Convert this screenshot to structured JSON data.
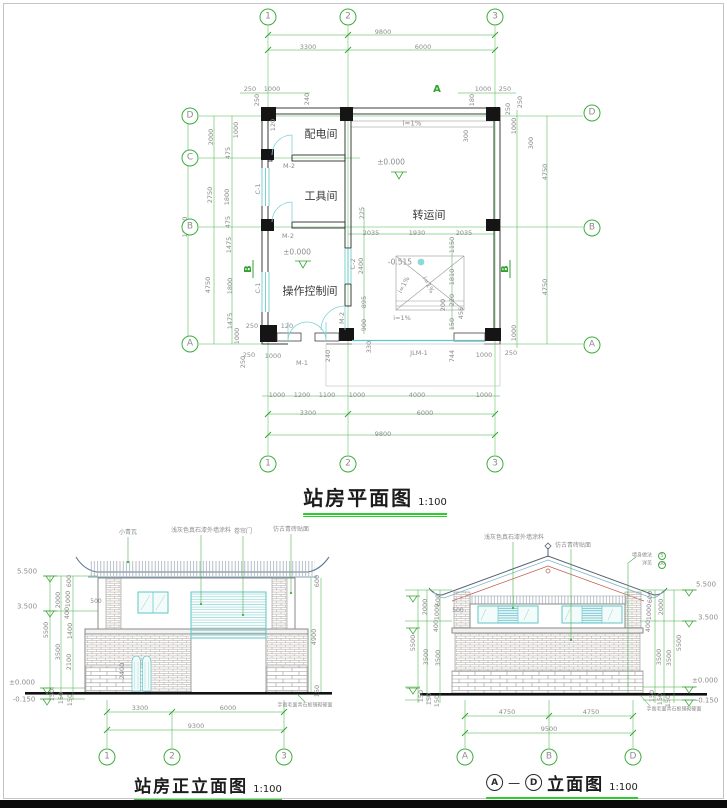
{
  "colors": {
    "dim_green": "#3cae3c",
    "dim_text": "#8c8c8c",
    "wall_black": "#1a1a1a",
    "glass_cyan": "#5fc6c6",
    "roof_blue": "#5a7b96",
    "accent_red": "#c05848",
    "title_underline_green": "#2ecc2e"
  },
  "titles": {
    "plan": {
      "text": "站房平面图",
      "scale": "1:100"
    },
    "front": {
      "text": "站房正立面图",
      "scale": "1:100"
    },
    "ad": {
      "a": "A",
      "dash": "—",
      "d": "D",
      "text": "立面图",
      "scale": "1:100"
    }
  },
  "labels": {
    "plan": [
      {
        "t": "9800",
        "x": 383,
        "y": 32
      },
      {
        "t": "3300",
        "x": 308,
        "y": 47
      },
      {
        "t": "6000",
        "x": 423,
        "y": 47
      },
      {
        "t": "250",
        "x": 250,
        "y": 89
      },
      {
        "t": "1000",
        "x": 272,
        "y": 89
      },
      {
        "t": "1000",
        "x": 483,
        "y": 89
      },
      {
        "t": "250",
        "x": 505,
        "y": 89
      },
      {
        "t": "A",
        "x": 437,
        "y": 90,
        "c": "g",
        "s": 10
      },
      {
        "t": "250",
        "x": 257,
        "y": 100,
        "r": -90
      },
      {
        "t": "240",
        "x": 307,
        "y": 99,
        "r": -90
      },
      {
        "t": "180",
        "x": 472,
        "y": 100,
        "r": -90
      },
      {
        "t": "250",
        "x": 520,
        "y": 102,
        "r": -90
      },
      {
        "t": "120",
        "x": 273,
        "y": 125,
        "r": -90
      },
      {
        "t": "2000",
        "x": 211,
        "y": 137,
        "r": -90
      },
      {
        "t": "2750",
        "x": 210,
        "y": 195,
        "r": -90
      },
      {
        "t": "10000",
        "x": 185,
        "y": 227,
        "r": -90
      },
      {
        "t": "4750",
        "x": 208,
        "y": 285,
        "r": -90
      },
      {
        "t": "1000",
        "x": 236,
        "y": 130,
        "r": -90
      },
      {
        "t": "475",
        "x": 228,
        "y": 153,
        "r": -90
      },
      {
        "t": "1800",
        "x": 227,
        "y": 197,
        "r": -90
      },
      {
        "t": "475",
        "x": 228,
        "y": 222,
        "r": -90
      },
      {
        "t": "1475",
        "x": 229,
        "y": 245,
        "r": -90
      },
      {
        "t": "1800",
        "x": 230,
        "y": 286,
        "r": -90
      },
      {
        "t": "1475",
        "x": 230,
        "y": 321,
        "r": -90
      },
      {
        "t": "1000",
        "x": 237,
        "y": 336,
        "r": -90
      },
      {
        "t": "250",
        "x": 243,
        "y": 362,
        "r": -90
      },
      {
        "t": "250",
        "x": 252,
        "y": 326
      },
      {
        "t": "120",
        "x": 287,
        "y": 326
      },
      {
        "t": "250",
        "x": 508,
        "y": 109,
        "r": -90
      },
      {
        "t": "1000",
        "x": 514,
        "y": 126,
        "r": -90
      },
      {
        "t": "4750",
        "x": 545,
        "y": 172,
        "r": -90
      },
      {
        "t": "4750",
        "x": 545,
        "y": 287,
        "r": -90
      },
      {
        "t": "1000",
        "x": 514,
        "y": 333,
        "r": -90
      },
      {
        "t": "300",
        "x": 531,
        "y": 143,
        "r": -90
      },
      {
        "t": "i=1%",
        "x": 412,
        "y": 124,
        "s": 7
      },
      {
        "t": "±0.000",
        "x": 391,
        "y": 162,
        "s": 7.5
      },
      {
        "t": "300",
        "x": 466,
        "y": 136,
        "r": -90
      },
      {
        "t": "225",
        "x": 362,
        "y": 213,
        "r": -90
      },
      {
        "t": "2035",
        "x": 371,
        "y": 233
      },
      {
        "t": "1930",
        "x": 417,
        "y": 233
      },
      {
        "t": "2035",
        "x": 464,
        "y": 233
      },
      {
        "t": "1150",
        "x": 452,
        "y": 245,
        "r": -90
      },
      {
        "t": "1810",
        "x": 452,
        "y": 277,
        "r": -90
      },
      {
        "t": "220",
        "x": 452,
        "y": 300,
        "r": -90
      },
      {
        "t": "200",
        "x": 443,
        "y": 305,
        "r": -90
      },
      {
        "t": "456",
        "x": 461,
        "y": 313,
        "r": -90
      },
      {
        "t": "150",
        "x": 452,
        "y": 324,
        "r": -90
      },
      {
        "t": "-0.515",
        "x": 400,
        "y": 262,
        "s": 7.5
      },
      {
        "t": "i=1%",
        "x": 404,
        "y": 285,
        "r": -62
      },
      {
        "t": "i=1%",
        "x": 428,
        "y": 285,
        "r": 62
      },
      {
        "t": "i=1%",
        "x": 402,
        "y": 318
      },
      {
        "t": "C-2",
        "x": 353,
        "y": 264,
        "r": -90
      },
      {
        "t": "2400",
        "x": 361,
        "y": 266,
        "r": -90
      },
      {
        "t": "895",
        "x": 364,
        "y": 302,
        "r": -90
      },
      {
        "t": "900",
        "x": 364,
        "y": 325,
        "r": -90
      },
      {
        "t": "配电间",
        "x": 321,
        "y": 134,
        "s": 11,
        "c": "k"
      },
      {
        "t": "工具间",
        "x": 321,
        "y": 196,
        "s": 11,
        "c": "k"
      },
      {
        "t": "转运间",
        "x": 429,
        "y": 215,
        "s": 11,
        "c": "k"
      },
      {
        "t": "操作控制间",
        "x": 310,
        "y": 291,
        "s": 11,
        "c": "k"
      },
      {
        "t": "M-2",
        "x": 289,
        "y": 166
      },
      {
        "t": "M-2",
        "x": 288,
        "y": 236
      },
      {
        "t": "M-2",
        "x": 342,
        "y": 318,
        "r": -90
      },
      {
        "t": "C-1",
        "x": 258,
        "y": 189,
        "r": -90
      },
      {
        "t": "C-1",
        "x": 258,
        "y": 288,
        "r": -90
      },
      {
        "t": "±0.000",
        "x": 297,
        "y": 252,
        "s": 7.5
      },
      {
        "t": "M-1",
        "x": 302,
        "y": 363
      },
      {
        "t": "JLM-1",
        "x": 419,
        "y": 353
      },
      {
        "t": "240",
        "x": 328,
        "y": 356,
        "r": -90
      },
      {
        "t": "330",
        "x": 369,
        "y": 347,
        "r": -90
      },
      {
        "t": "744",
        "x": 452,
        "y": 356,
        "r": -90
      },
      {
        "t": "250",
        "x": 249,
        "y": 355
      },
      {
        "t": "1000",
        "x": 273,
        "y": 356
      },
      {
        "t": "1000",
        "x": 484,
        "y": 355
      },
      {
        "t": "250",
        "x": 511,
        "y": 353
      },
      {
        "t": "B",
        "x": 249,
        "y": 269,
        "r": -90,
        "c": "g",
        "s": 10
      },
      {
        "t": "B",
        "x": 506,
        "y": 269,
        "r": -90,
        "c": "g",
        "s": 10
      },
      {
        "t": "1000",
        "x": 277,
        "y": 395
      },
      {
        "t": "1200",
        "x": 302,
        "y": 395
      },
      {
        "t": "1100",
        "x": 327,
        "y": 395
      },
      {
        "t": "1000",
        "x": 357,
        "y": 395
      },
      {
        "t": "4000",
        "x": 417,
        "y": 395
      },
      {
        "t": "1000",
        "x": 484,
        "y": 395
      },
      {
        "t": "3300",
        "x": 308,
        "y": 413
      },
      {
        "t": "6000",
        "x": 425,
        "y": 413
      },
      {
        "t": "9800",
        "x": 383,
        "y": 434
      }
    ],
    "front": [
      {
        "t": "小青瓦",
        "x": 128,
        "y": 533,
        "s": 6
      },
      {
        "t": "浅灰色真石漆外墙涂料",
        "x": 201,
        "y": 531,
        "s": 6
      },
      {
        "t": "卷帘门",
        "x": 243,
        "y": 532,
        "s": 6
      },
      {
        "t": "仿古青砖贴面",
        "x": 291,
        "y": 530,
        "s": 6
      },
      {
        "t": "5.500",
        "x": 27,
        "y": 572,
        "s": 7
      },
      {
        "t": "3.500",
        "x": 27,
        "y": 607,
        "s": 7
      },
      {
        "t": "±0.000",
        "x": 22,
        "y": 683,
        "s": 7
      },
      {
        "t": "-0.150",
        "x": 24,
        "y": 700,
        "s": 7
      },
      {
        "t": "5500",
        "x": 46,
        "y": 630,
        "r": -90
      },
      {
        "t": "2000",
        "x": 58,
        "y": 600,
        "r": -90
      },
      {
        "t": "3500",
        "x": 58,
        "y": 652,
        "r": -90
      },
      {
        "t": "600",
        "x": 69,
        "y": 581,
        "r": -90
      },
      {
        "t": "1000",
        "x": 68,
        "y": 599,
        "r": -90
      },
      {
        "t": "400",
        "x": 67,
        "y": 613,
        "r": -90
      },
      {
        "t": "1400",
        "x": 70,
        "y": 631,
        "r": -90
      },
      {
        "t": "2100",
        "x": 69,
        "y": 662,
        "r": -90
      },
      {
        "t": "150",
        "x": 52,
        "y": 695,
        "r": -90
      },
      {
        "t": "150",
        "x": 61,
        "y": 698,
        "r": -90
      },
      {
        "t": "150",
        "x": 70,
        "y": 700,
        "r": -90
      },
      {
        "t": "500",
        "x": 96,
        "y": 602,
        "s": 6
      },
      {
        "t": "2400",
        "x": 122,
        "y": 671,
        "r": -90
      },
      {
        "t": "600",
        "x": 317,
        "y": 581,
        "r": -90
      },
      {
        "t": "4900",
        "x": 314,
        "y": 637,
        "r": -90
      },
      {
        "t": "150",
        "x": 317,
        "y": 691,
        "r": -90
      },
      {
        "t": "3300",
        "x": 140,
        "y": 708
      },
      {
        "t": "6000",
        "x": 228,
        "y": 708
      },
      {
        "t": "9300",
        "x": 196,
        "y": 726
      },
      {
        "t": "手凿毛面青石板铺砌硬面",
        "x": 305,
        "y": 706,
        "s": 5
      }
    ],
    "ad": [
      {
        "t": "浅灰色真石漆外墙涂料",
        "x": 514,
        "y": 538,
        "s": 6
      },
      {
        "t": "仿古青砖贴面",
        "x": 573,
        "y": 546,
        "s": 6
      },
      {
        "t": "墙身做法",
        "x": 642,
        "y": 556,
        "s": 5
      },
      {
        "t": "详见",
        "x": 647,
        "y": 564,
        "s": 5
      },
      {
        "t": "5.500",
        "x": 706,
        "y": 585,
        "s": 7
      },
      {
        "t": "3.500",
        "x": 708,
        "y": 618,
        "s": 7
      },
      {
        "t": "±0.000",
        "x": 705,
        "y": 681,
        "s": 7
      },
      {
        "t": "-0.150",
        "x": 707,
        "y": 701,
        "s": 7
      },
      {
        "t": "600",
        "x": 650,
        "y": 597,
        "r": -90
      },
      {
        "t": "1000",
        "x": 649,
        "y": 612,
        "r": -90
      },
      {
        "t": "400",
        "x": 648,
        "y": 626,
        "r": -90
      },
      {
        "t": "2000",
        "x": 661,
        "y": 607,
        "r": -90
      },
      {
        "t": "3500",
        "x": 659,
        "y": 657,
        "r": -90
      },
      {
        "t": "3500",
        "x": 669,
        "y": 658,
        "r": -90
      },
      {
        "t": "5500",
        "x": 679,
        "y": 643,
        "r": -90
      },
      {
        "t": "150",
        "x": 652,
        "y": 696,
        "r": -90
      },
      {
        "t": "150",
        "x": 660,
        "y": 699,
        "r": -90
      },
      {
        "t": "150",
        "x": 668,
        "y": 701,
        "r": -90
      },
      {
        "t": "600",
        "x": 438,
        "y": 600,
        "r": -90
      },
      {
        "t": "1000",
        "x": 437,
        "y": 612,
        "r": -90
      },
      {
        "t": "400",
        "x": 436,
        "y": 626,
        "r": -90
      },
      {
        "t": "2000",
        "x": 425,
        "y": 607,
        "r": -90
      },
      {
        "t": "3500",
        "x": 426,
        "y": 657,
        "r": -90
      },
      {
        "t": "3500",
        "x": 438,
        "y": 658,
        "r": -90
      },
      {
        "t": "5500",
        "x": 413,
        "y": 643,
        "r": -90
      },
      {
        "t": "150",
        "x": 421,
        "y": 696,
        "r": -90
      },
      {
        "t": "150",
        "x": 429,
        "y": 699,
        "r": -90
      },
      {
        "t": "150",
        "x": 437,
        "y": 701,
        "r": -90
      },
      {
        "t": "500",
        "x": 458,
        "y": 611,
        "s": 6
      },
      {
        "t": "4750",
        "x": 507,
        "y": 712
      },
      {
        "t": "4750",
        "x": 591,
        "y": 712
      },
      {
        "t": "9500",
        "x": 549,
        "y": 729
      },
      {
        "t": "手凿毛面青石板铺砌硬面",
        "x": 674,
        "y": 710,
        "s": 5
      }
    ]
  },
  "bubbles": {
    "plan": [
      {
        "t": "1",
        "x": 268,
        "y": 17
      },
      {
        "t": "2",
        "x": 348,
        "y": 17
      },
      {
        "t": "3",
        "x": 495,
        "y": 17
      },
      {
        "t": "1",
        "x": 268,
        "y": 464
      },
      {
        "t": "2",
        "x": 348,
        "y": 464
      },
      {
        "t": "3",
        "x": 495,
        "y": 464
      },
      {
        "t": "D",
        "x": 190,
        "y": 116
      },
      {
        "t": "C",
        "x": 190,
        "y": 158
      },
      {
        "t": "B",
        "x": 190,
        "y": 227
      },
      {
        "t": "A",
        "x": 190,
        "y": 344
      },
      {
        "t": "D",
        "x": 592,
        "y": 113
      },
      {
        "t": "B",
        "x": 592,
        "y": 228
      },
      {
        "t": "A",
        "x": 592,
        "y": 345
      }
    ],
    "front": [
      {
        "t": "1",
        "x": 107,
        "y": 757
      },
      {
        "t": "2",
        "x": 172,
        "y": 757
      },
      {
        "t": "3",
        "x": 284,
        "y": 757
      }
    ],
    "ad": [
      {
        "t": "A",
        "x": 465,
        "y": 757
      },
      {
        "t": "B",
        "x": 549,
        "y": 757
      },
      {
        "t": "D",
        "x": 633,
        "y": 757
      },
      {
        "t": "5",
        "x": 662,
        "y": 556,
        "d": 8,
        "s": 5
      },
      {
        "t": "06",
        "x": 662,
        "y": 565,
        "d": 8,
        "s": 4.5
      }
    ]
  }
}
